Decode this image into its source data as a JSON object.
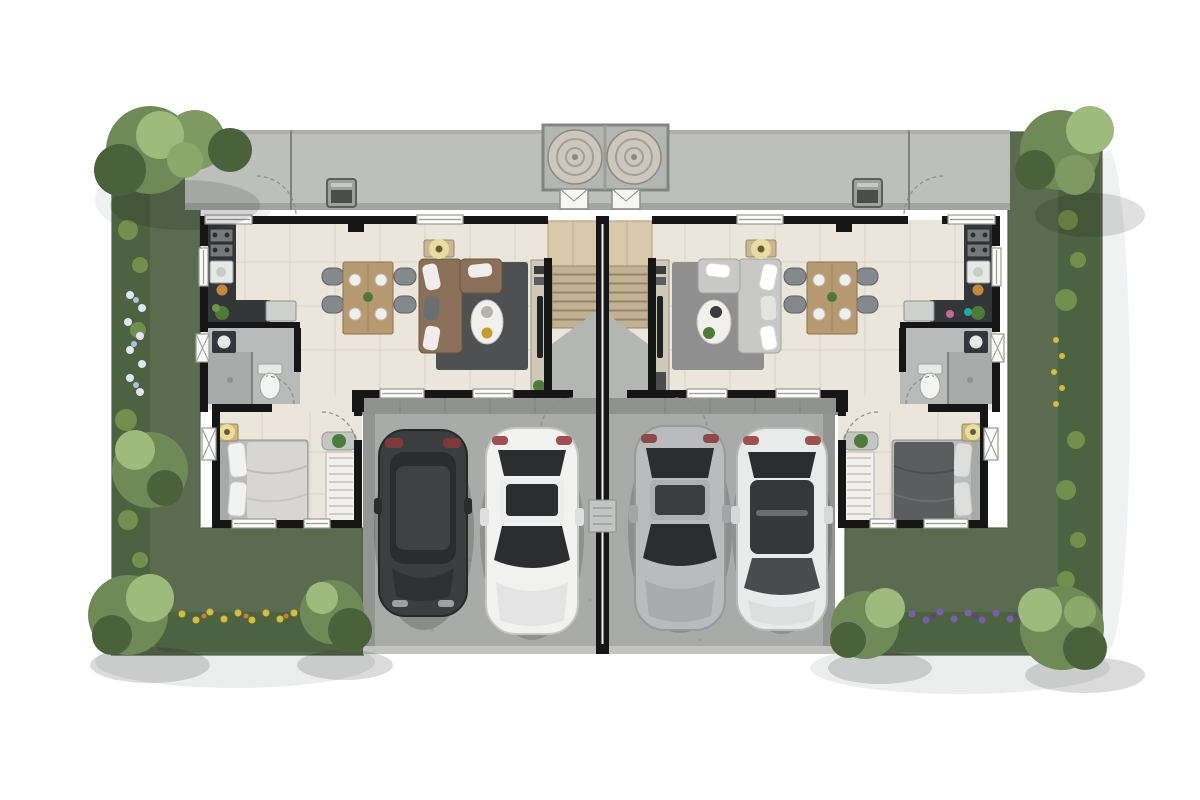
{
  "scene": {
    "kind": "twin-house-floor-plan",
    "description": "Top-down rendered floor plan of a mirrored duplex: rear walkway with two water tanks, two mirrored living units with kitchen, bathroom, living-dining room, staircase and bedroom, double carports with four cars, lawns and flowering hedges around the perimeter",
    "background": "#ffffff"
  },
  "palette": {
    "grass": "#5a6b50",
    "grassEdge": "#4c5c43",
    "hedge": "#4d6240",
    "hedgeLight": "#7d9b52",
    "canopy": "#6f8a57",
    "canopyLight": "#9fba7d",
    "canopyDark": "#4a613c",
    "walkway": "#bcbfbc",
    "walkwayEdge": "#a2a5a2",
    "porchTile": "#8f928f",
    "garageSlab": "#a9aba9",
    "curb": "#939593",
    "wall": "#161616",
    "floor": "#ebe6db",
    "tileLine": "#d9d3c5",
    "bathFloor": "#b7bbba",
    "shower": "#a7abaa",
    "counter": "#34373a",
    "appliance": "#75797c",
    "wood": "#b79a72",
    "stairWood": "#c3b193",
    "landingWood": "#d8c9ab",
    "underStair": "#b4b6b4",
    "rugDark": "#4e5051",
    "rugLight": "#8e8f8e",
    "sofaBrown": "#8a7058",
    "sofaGray": "#c8c8c6",
    "cushion": "#efeeec",
    "bedLight": "#d7d6d3",
    "bedDark": "#5b5d5f",
    "wardrobe": "#f1f0ed",
    "tableWhite": "#f1f0ed",
    "glass": "#2b2d2f",
    "carDark": "#3b3d3f",
    "carWhite": "#f2f2f1",
    "carSilver": "#b9bbbc",
    "carPearl": "#e9eaea",
    "tank": "#cdc8be",
    "tankRing": "#a59f93",
    "flowerYellow": "#d3bc3e",
    "flowerPurple": "#7a5fa8",
    "flowerWhite": "#dfe7f2",
    "ac": "#9ea19e",
    "lampGlow": "#f0e3a6",
    "plant": "#4e7a3a",
    "shadow": "#9aa0a0"
  },
  "site": {
    "water_tanks": 2,
    "ac_units": 2,
    "vehicles": [
      {
        "name": "suv-dark-gray",
        "position": "left-carport"
      },
      {
        "name": "sedan-white",
        "position": "left-carport"
      },
      {
        "name": "sedan-silver",
        "position": "right-carport"
      },
      {
        "name": "sedan-pearl-white",
        "position": "right-carport"
      }
    ],
    "units": [
      {
        "id": "left",
        "rooms": [
          "kitchen",
          "bathroom",
          "living-dining",
          "staircase",
          "bedroom",
          "carport"
        ]
      },
      {
        "id": "right",
        "rooms": [
          "kitchen",
          "bathroom",
          "living-dining",
          "staircase",
          "bedroom",
          "carport"
        ]
      }
    ]
  }
}
